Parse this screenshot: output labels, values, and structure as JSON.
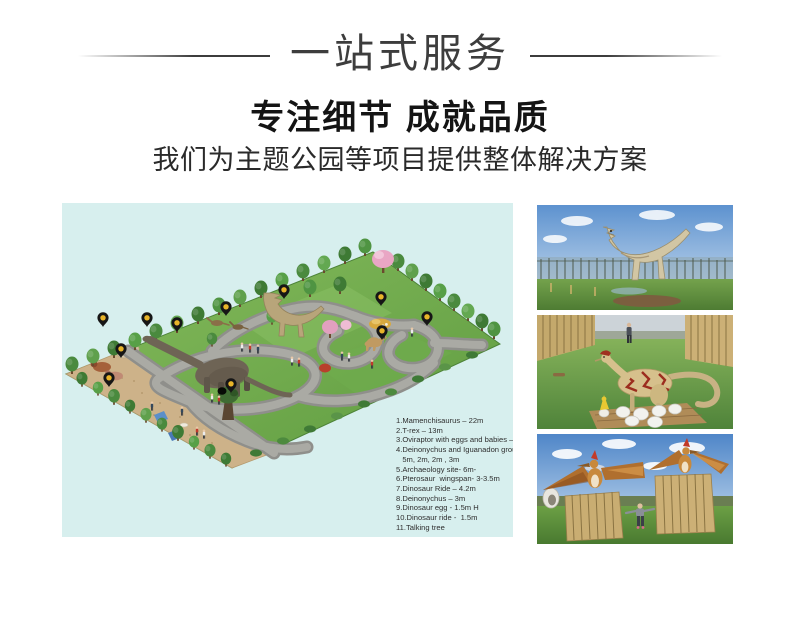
{
  "page": {
    "width": 800,
    "height": 626,
    "background": "#ffffff"
  },
  "header": {
    "banner_title": "一站式服务",
    "headline": "专注细节 成就品质",
    "subheadline": "我们为主题公园等项目提供整体解决方案",
    "title_color": "#3d3d3d",
    "headline_color": "#141414"
  },
  "park_map": {
    "background_color": "#d7efee",
    "pin_color": "#161616",
    "pin_dot_color": "#e8b429",
    "pin_count": 11,
    "legend": {
      "text_color": "#2f2f2f",
      "lines": [
        "1.Mamenchisaurus – 22m",
        "2.T-rex – 13m",
        "3.Oviraptor with eggs and babies – 3m",
        "4.Deinonychus and Iguanadon group",
        "   5m, 2m, 2m , 3m",
        "5.Archaeology site- 6m-",
        "6.Pterosaur  wingspan- 3-3.5m",
        "7.Dinosaur Ride – 4.2m",
        "8.Deinonychus – 3m",
        "9.Dinosaur egg - 1.5m H",
        "10.Dinosaur ride -  1.5m",
        "11.Talking tree"
      ]
    }
  },
  "photos": [
    {
      "name": "photo-t-rex",
      "alt": "T-rex animatronic model standing on grass in a park"
    },
    {
      "name": "photo-oviraptor-eggs",
      "alt": "Oviraptor model with white eggs and a hatchling on a wooden base"
    },
    {
      "name": "photo-pterosaurs",
      "alt": "Two pterosaur models with spread wings perched on wooden stockades"
    }
  ]
}
